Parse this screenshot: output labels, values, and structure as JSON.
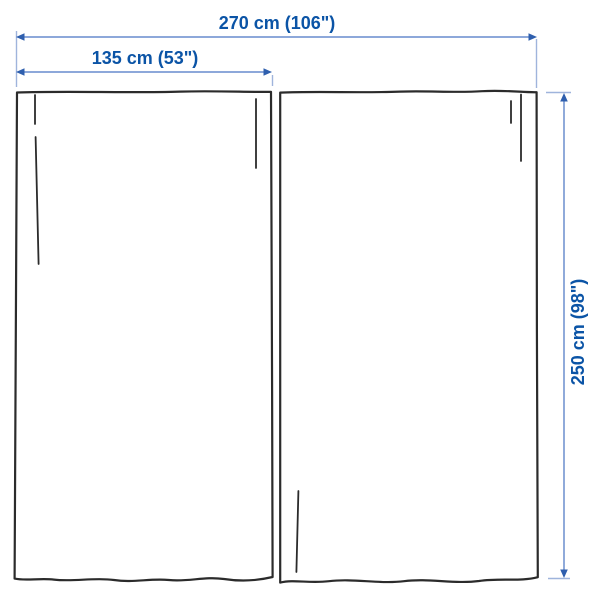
{
  "diagram": {
    "panel_count": 2,
    "dimensions": {
      "total_width": {
        "label": "270 cm (106\")"
      },
      "panel_width": {
        "label": "135 cm (53\")"
      },
      "height": {
        "label": "250 cm (98\")"
      }
    }
  },
  "colors": {
    "dim-text": "#0b54a6",
    "dim-line": "#7d9cd4",
    "ext-line": "#9fb4dc",
    "dim-arrow": "#2f5fae",
    "outline": "#2b2b2b",
    "background": "#ffffff"
  }
}
